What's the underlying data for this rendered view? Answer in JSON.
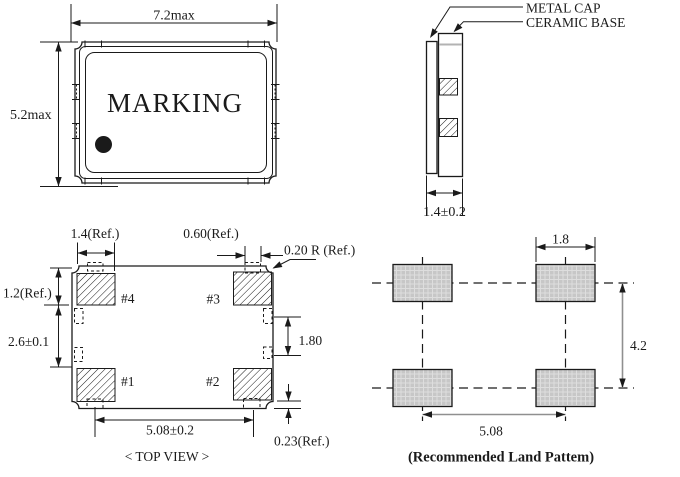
{
  "front_view": {
    "marking": "MARKING",
    "dim_width": "7.2max",
    "dim_height": "5.2max"
  },
  "side_view": {
    "metal_cap": "METAL CAP",
    "ceramic_base": "CERAMIC BASE",
    "dim_thickness": "1.4±0.2"
  },
  "top_view": {
    "caption": "< TOP VIEW >",
    "pad1": "#1",
    "pad2": "#2",
    "pad3": "#3",
    "pad4": "#4",
    "dim_pad_width": "1.4(Ref.)",
    "dim_castellation": "0.60(Ref.)",
    "dim_corner_radius": "0.20 R (Ref.)",
    "dim_pad_height": "1.2(Ref.)",
    "dim_pad_gap": "2.6±0.1",
    "dim_side_pitch": "1.80",
    "dim_pad_pitch": "5.08±0.2",
    "dim_edge_offset": "0.23(Ref.)"
  },
  "land_pattern": {
    "caption": "(Recommended Land Pattem)",
    "dim_pad_width": "1.8",
    "dim_row_pitch": "4.2",
    "dim_col_pitch": "5.08"
  },
  "colors": {
    "line": "#1a1a1a",
    "land_pad_fill": "#c7c7c7",
    "land_pad_grid": "#dedede",
    "dim_gray": "#8f8f8f"
  }
}
